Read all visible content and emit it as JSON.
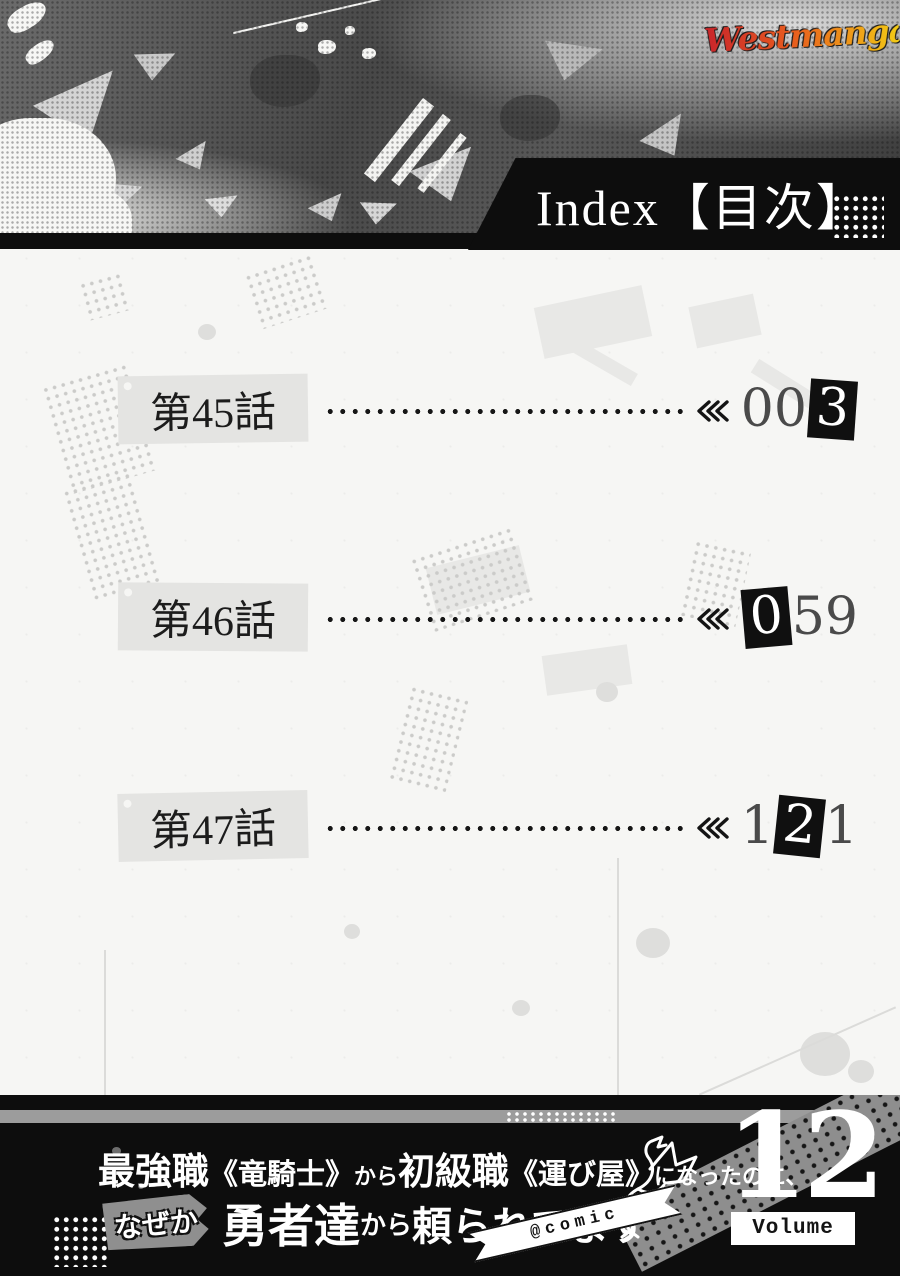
{
  "site": {
    "logo_text": "Westmanga.tv"
  },
  "header": {
    "title_en": "Index",
    "title_jp_bracketed": "【目次】"
  },
  "toc": {
    "items": [
      {
        "label": "第45話",
        "page": "003",
        "digits": {
          "prefix": "00",
          "highlight": "3",
          "suffix": ""
        }
      },
      {
        "label": "第46話",
        "page": "059",
        "digits": {
          "prefix": "",
          "highlight": "0",
          "suffix": "59"
        }
      },
      {
        "label": "第47話",
        "page": "121",
        "digits": {
          "prefix": "1",
          "highlight": "2",
          "suffix": "1"
        }
      }
    ]
  },
  "footer": {
    "series_title_line1": [
      "最強職",
      "《竜騎士》",
      "から",
      "初級職",
      "《運び屋》",
      "になったのに、"
    ],
    "nazeka_bubble": "なぜか",
    "series_title_line2": [
      "勇者達",
      "から",
      "頼られてます"
    ],
    "comic_badge": "@comic",
    "volume_number": "12",
    "volume_label": "Volume"
  },
  "colors": {
    "banner_black": "#0d0d0d",
    "page_bg": "#f6f6f4",
    "chapter_box_gray": "#e4e4e2",
    "stripe_gray": "#9c9c9c",
    "bubble_gray": "#8f8f8f",
    "logo_gradient_start": "#c8242b",
    "logo_gradient_end": "#f3cb15"
  }
}
